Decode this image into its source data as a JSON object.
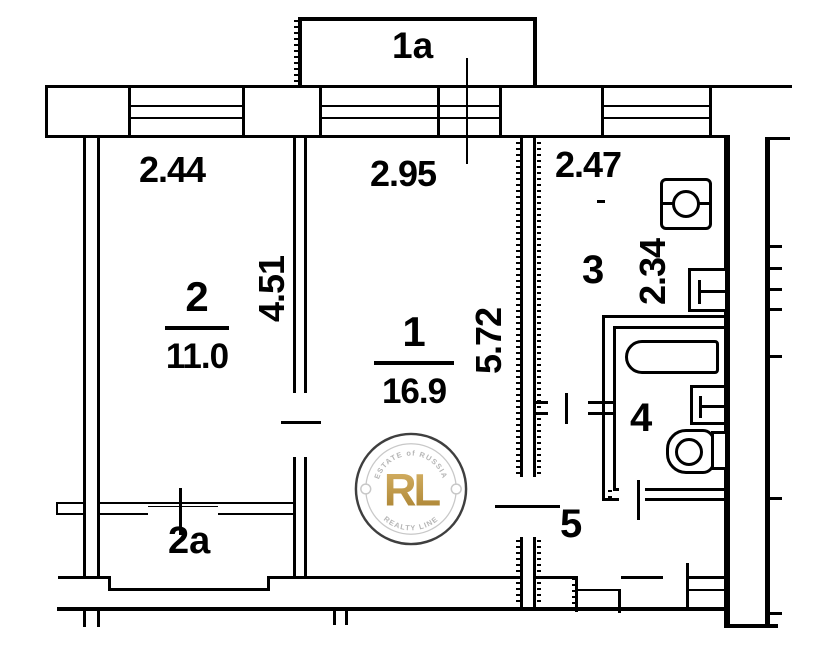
{
  "plan_title": "apartment-floor-plan",
  "rooms": {
    "r1a": {
      "label": "1a"
    },
    "r2": {
      "label": "2",
      "area": "11.0",
      "dim_w": "2.44",
      "dim_h": "4.51"
    },
    "r2a": {
      "label": "2a"
    },
    "r1": {
      "label": "1",
      "area": "16.9",
      "dim_w": "2.95",
      "dim_h": "5.72"
    },
    "r3": {
      "label": "3",
      "dim_w": "2.47",
      "dim_h": "2.34"
    },
    "r4": {
      "label": "4"
    },
    "r5": {
      "label": "5"
    }
  },
  "fixtures": [
    "stove",
    "kitchen-sink",
    "bathtub",
    "wash-basin",
    "toilet"
  ],
  "watermark": {
    "top_arc": "ESTATE of RUSSIA",
    "monogram": "RL",
    "bottom_arc": "REALTY LINE",
    "gold_color": "#c09a3e",
    "gray_color": "#b5b5b5",
    "ring_color": "#3f3f3f"
  },
  "colors": {
    "line": "#000000",
    "background": "#ffffff"
  }
}
